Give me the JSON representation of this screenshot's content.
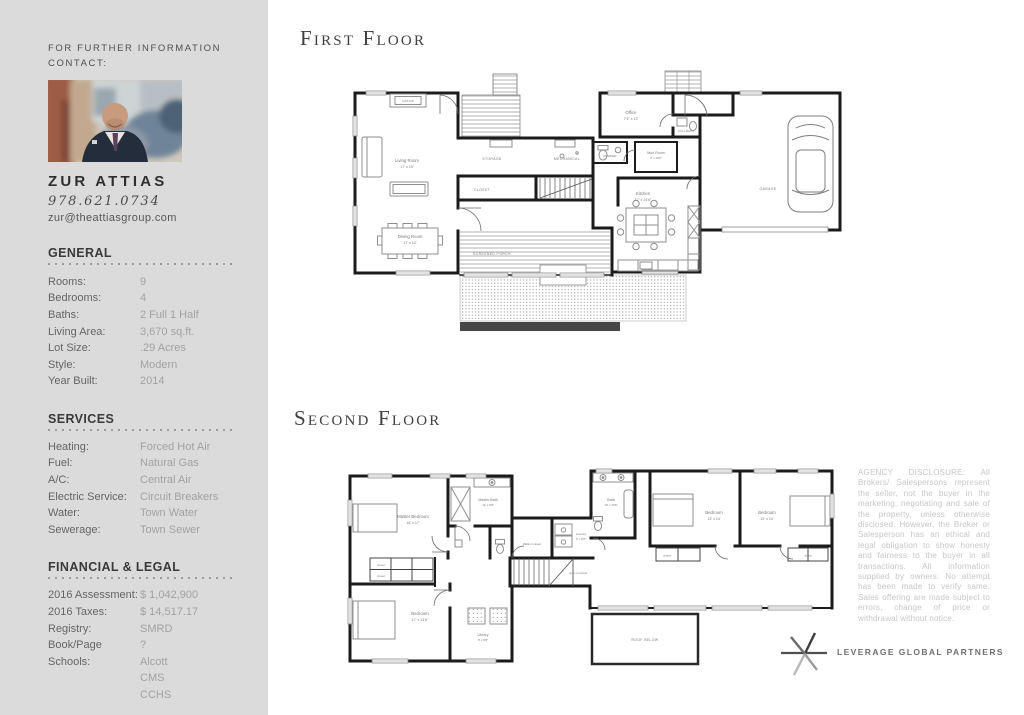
{
  "window": {
    "width": 1024,
    "height": 715
  },
  "colors": {
    "sidebar_bg": "#dbdbdb",
    "heading_dark": "#3a3a3a",
    "label_gray": "#656565",
    "value_gray": "#a2a2a2",
    "plan_wall": "#1b1b1b",
    "disclosure_gray": "#c6c6c6",
    "logo_gray": "#6f6f6f"
  },
  "sidebar": {
    "contact_heading": "FOR FURTHER INFORMATION\nCONTACT:",
    "agent": {
      "name": "ZUR ATTIAS",
      "phone": "978.621.0734",
      "email": "zur@theattiasgroup.com",
      "photo": "agent-portrait-photo"
    },
    "sections": [
      {
        "title": "GENERAL",
        "rows": [
          {
            "label": "Rooms:",
            "value": "9"
          },
          {
            "label": "Bedrooms:",
            "value": "4"
          },
          {
            "label": "Baths:",
            "value": "2 Full 1 Half"
          },
          {
            "label": "Living Area:",
            "value": "3,670 sq.ft."
          },
          {
            "label": "Lot Size:",
            "value": ".29 Acres"
          },
          {
            "label": "Style:",
            "value": "Modern"
          },
          {
            "label": "Year Built:",
            "value": "2014"
          }
        ]
      },
      {
        "title": "SERVICES",
        "rows": [
          {
            "label": "Heating:",
            "value": "Forced Hot Air"
          },
          {
            "label": "Fuel:",
            "value": "Natural Gas"
          },
          {
            "label": "A/C:",
            "value": "Central Air"
          },
          {
            "label": "Electric Service:",
            "value": "Circuit Breakers"
          },
          {
            "label": "Water:",
            "value": "Town Water"
          },
          {
            "label": "Sewerage:",
            "value": "Town Sewer"
          }
        ]
      },
      {
        "title": "FINANCIAL & LEGAL",
        "rows": [
          {
            "label": "2016 Assessment:",
            "value": "$ 1,042,900"
          },
          {
            "label": "2016 Taxes:",
            "value": "$ 14,517.17"
          },
          {
            "label": "Registry:",
            "value": "SMRD"
          },
          {
            "label": "Book/Page",
            "value": "?"
          },
          {
            "label": "Schools:",
            "value": "Alcott"
          },
          {
            "label": "",
            "value": "CMS"
          },
          {
            "label": "",
            "value": "CCHS"
          }
        ]
      }
    ]
  },
  "first_floor": {
    "heading": "First Floor",
    "labels": {
      "living_name": "Living Room",
      "living_dims": "17' x 19'",
      "dining_name": "Dining Room",
      "dining_dims": "17' x 12'",
      "storage": "STORAGE",
      "mechanical": "MECHANICAL",
      "closet": "CLOSET",
      "screened": "SCREENED PORCH",
      "office_name": "Office",
      "office_dims": "7'4\" x 13'",
      "full_bath": "FULL BATH",
      "powder": "POWDER",
      "mud_name": "Mud Room",
      "mud_dims": "8' x 10'6\"",
      "kitchen_name": "Kitchen",
      "kitchen_dims": "17' x 14'6\"",
      "garage": "GARAGE",
      "fireplace": "GAS F/P"
    }
  },
  "second_floor": {
    "heading": "Second Floor",
    "labels": {
      "master_name": "Master Bedroom",
      "master_dims": "16' x 17'",
      "mbath_name": "Master Bath",
      "mbath_dims": "14' x 9'8\"",
      "walkin": "Walk-in closet",
      "laundry_name": "Laundry",
      "laundry_dims": "6' x 6'6\"",
      "open_below": "open to below",
      "bed2_name": "Bedroom",
      "bed2_dims": "17' x 13'6\"",
      "library_name": "Library",
      "library_dims": "8' x 9'8\"",
      "bath_name": "Bath",
      "bath_dims": "10' x 10'6\"",
      "bed3_name": "Bedroom",
      "bed3_dims": "13' x 14'",
      "bed4_name": "Bedroom",
      "bed4_dims": "12' x 14'",
      "closet": "closet",
      "roof": "ROOF BELOW"
    }
  },
  "disclosure": "AGENCY DISCLOSURE: All Brokers/ Salespersons represent the seller, not the buyer in the marketing, negotiating and sale of the property, unless otherwise disclosed. However, the Broker or Salesperson has an ethical and legal obligation to show honesty and fairness to the buyer in all transactions. All information supplied by owners. No attempt has been made to verify same. Sales offering are made subject to errors, change of price or withdrawal without notice.",
  "logo": {
    "icon": "leverage-star-icon",
    "text": "LEVERAGE GLOBAL PARTNERS"
  }
}
